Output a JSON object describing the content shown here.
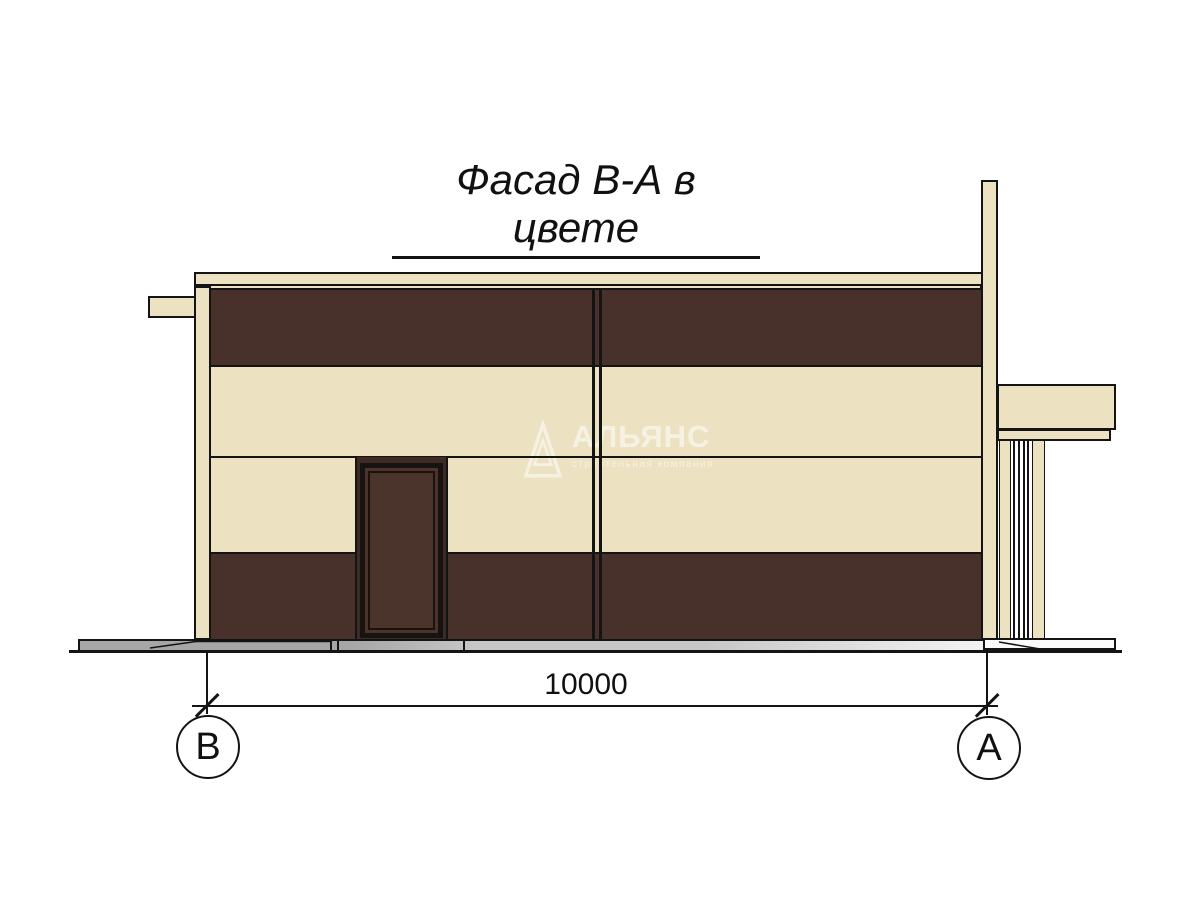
{
  "title": {
    "text": "Фасад В-А в цвете"
  },
  "dimension": {
    "value": "10000"
  },
  "axes": {
    "left": "В",
    "right": "А"
  },
  "watermark": {
    "name": "АЛЬЯНС",
    "subtitle": "строительная компания"
  },
  "colors": {
    "cream": "#ece2c2",
    "dark_brown": "#47312a",
    "door_brown": "#4b342c",
    "recess_brown": "#402b24",
    "line": "#141414",
    "plinth_dark": "#a6a6a6",
    "plinth_mid": "#c6c6c6",
    "plinth_light": "#f4f4f4",
    "watermark": "rgba(255,255,255,0.55)"
  }
}
